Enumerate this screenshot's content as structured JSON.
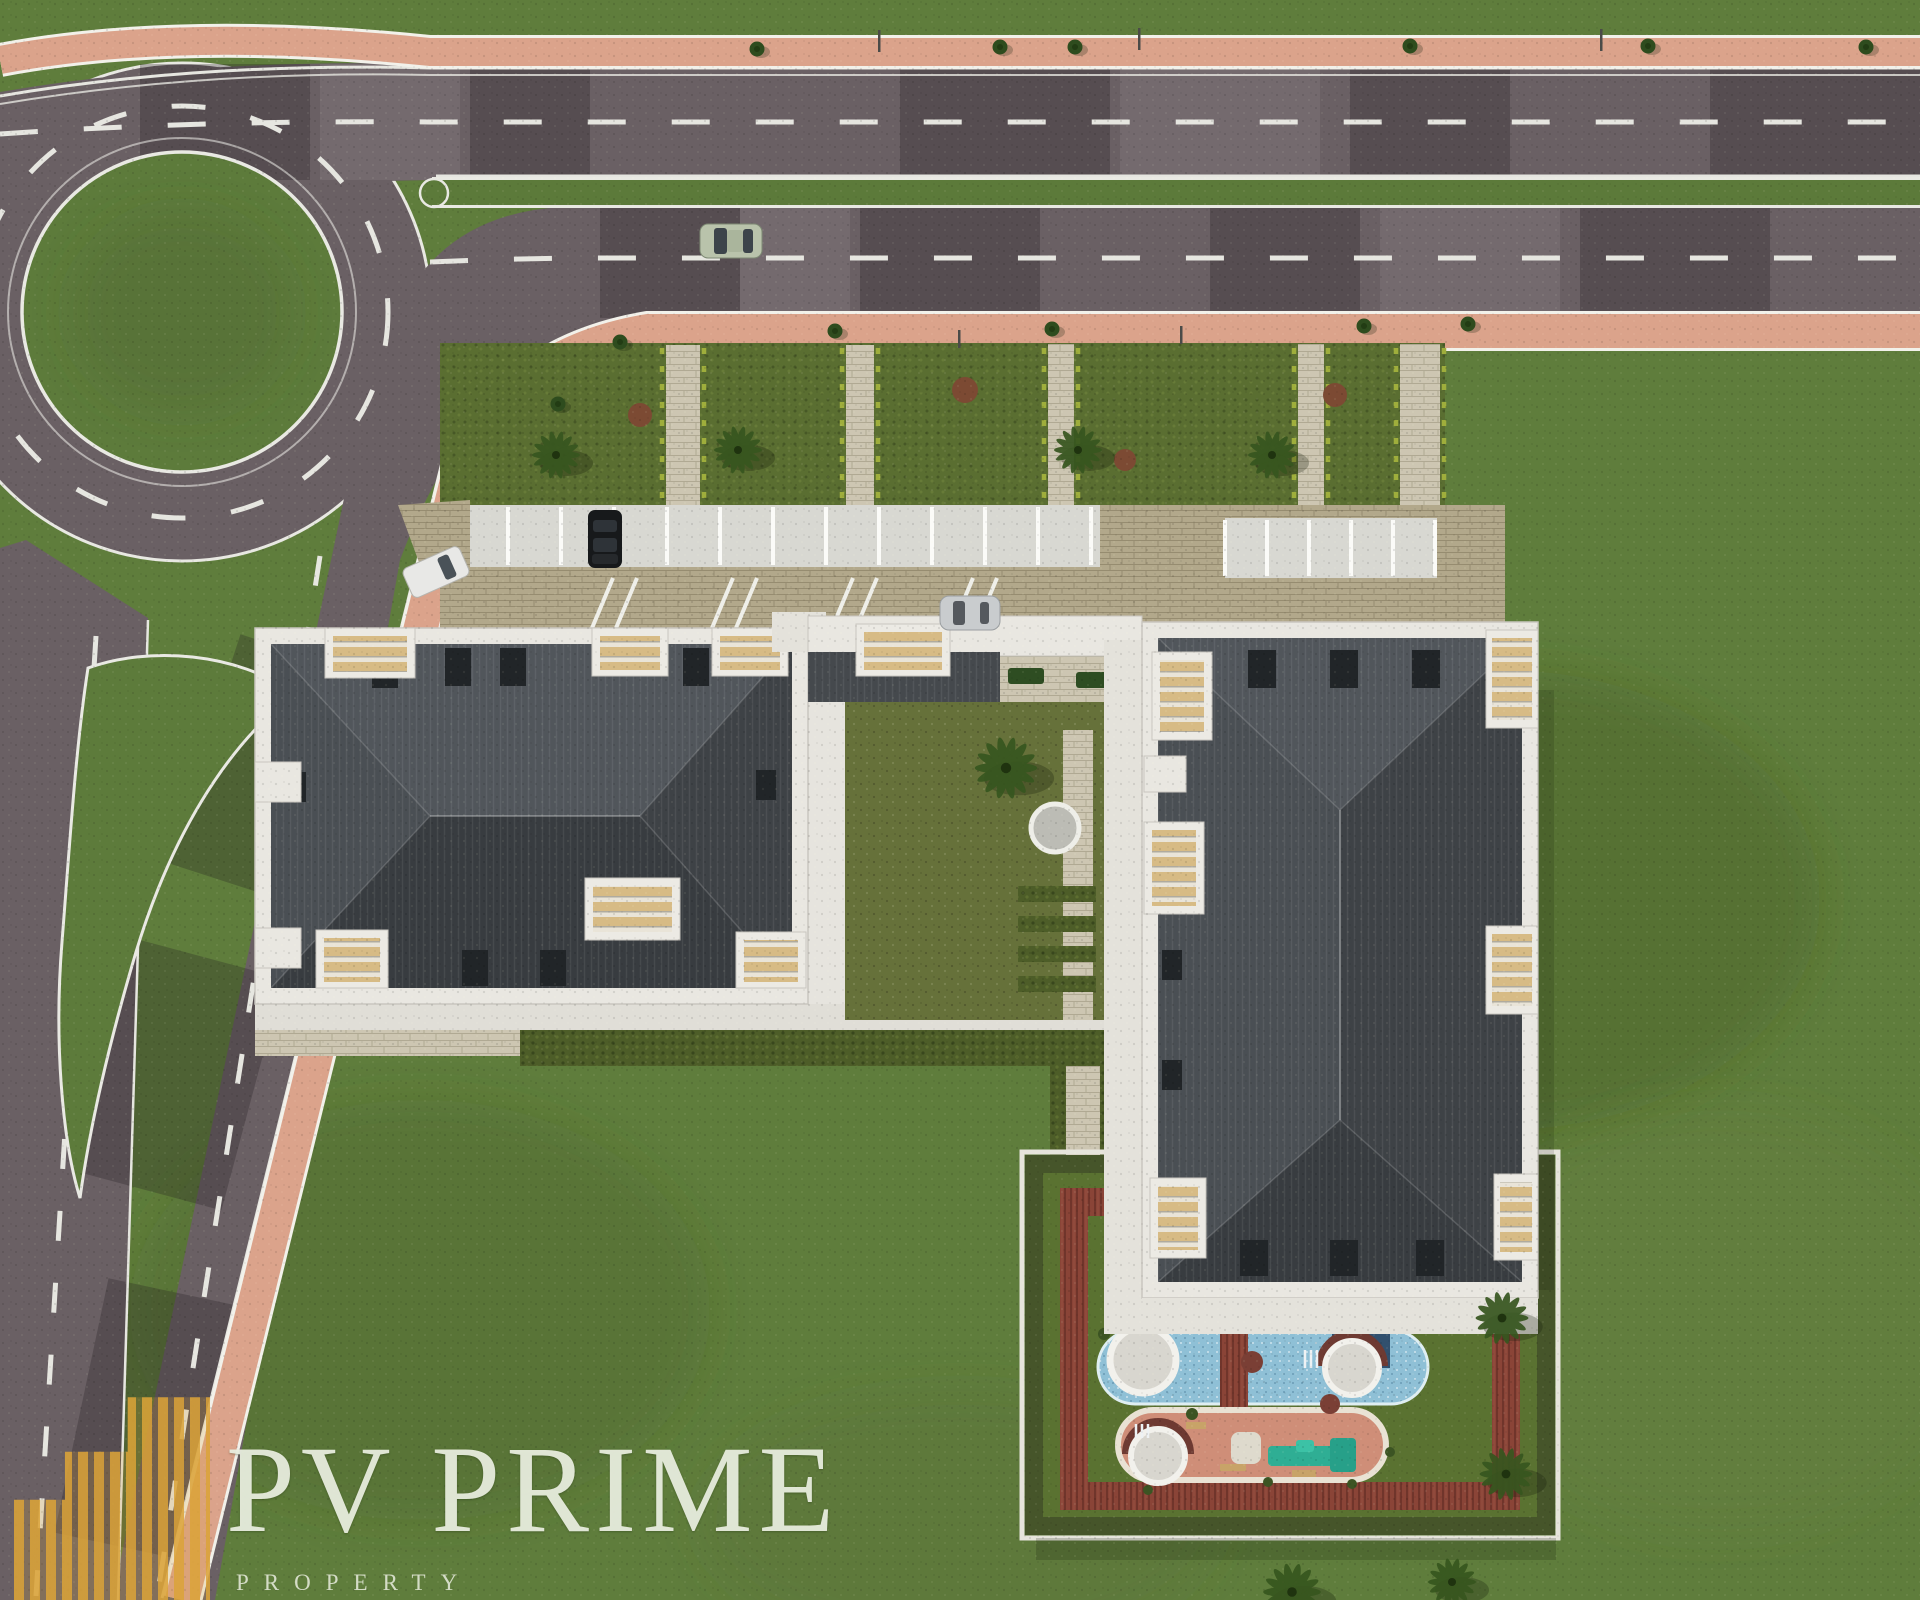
{
  "logo": {
    "brand": "PV PRIME",
    "tagline": "PROPERTY"
  },
  "scene": {
    "type": "aerial-architectural-site-plan-render",
    "features": [
      "roundabout",
      "dual-carriageway",
      "pink pedestrian sidewalks",
      "landscaped garden strips with palms",
      "parking rows",
      "apartment block A",
      "apartment block B",
      "inner courtyard with round spa",
      "amenity zone with pool, playground and deck track",
      "large lawn"
    ],
    "vehicles": [
      "sage sedan driving on lower road",
      "black suv parked",
      "white van at side entrance",
      "silver car at block B entrance"
    ]
  },
  "palette": {
    "grass": "#5f7d3c",
    "asphalt": "#6a6064",
    "sidewalk": "#dba38b",
    "roof": "#45494d",
    "parapet": "#e9e7e1",
    "cobble": "#b2a88b",
    "deck": "#8a4437",
    "pool": "#8fc0d6",
    "playground": "#cf8e78",
    "louver": "#d7bb85",
    "logo_gold": "#dba338",
    "brand_text": "#ecf0e2"
  }
}
